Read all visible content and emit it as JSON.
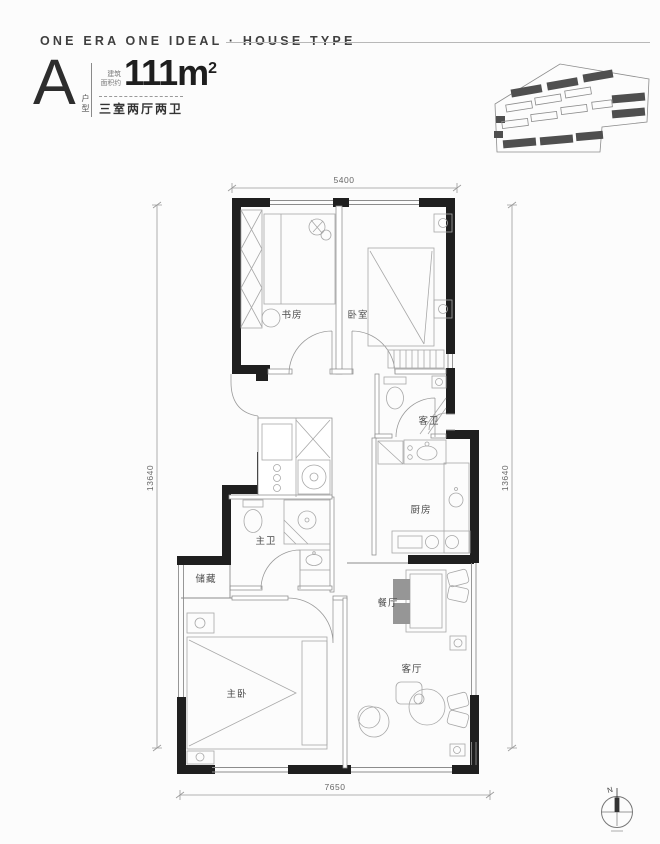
{
  "header": {
    "title": "ONE ERA ONE IDEAL · HOUSE TYPE"
  },
  "unit": {
    "letter": "A",
    "letter_caption": "户型",
    "area_label_line1": "建筑",
    "area_label_line2": "面积约",
    "area_value": "111m",
    "area_sup": "2",
    "layout_text": "三室两厅两卫"
  },
  "floorplan": {
    "dimensions": {
      "top": "5400",
      "left": "13640",
      "right": "13640",
      "bottom": "7650"
    },
    "rooms": [
      {
        "id": "study",
        "label": "书房"
      },
      {
        "id": "bedroom",
        "label": "卧室"
      },
      {
        "id": "guest-bath",
        "label": "客卫"
      },
      {
        "id": "kitchen",
        "label": "厨房"
      },
      {
        "id": "master-bath",
        "label": "主卫"
      },
      {
        "id": "storage",
        "label": "储藏"
      },
      {
        "id": "dining",
        "label": "餐厅"
      },
      {
        "id": "master-bedroom",
        "label": "主卧"
      },
      {
        "id": "living",
        "label": "客厅"
      }
    ],
    "compass": {
      "label": "N"
    }
  },
  "colors": {
    "wall": "#1f1f1f",
    "thin_line": "#8c8c8c",
    "furniture": "#a8a8a8",
    "text": "#3f3f3f"
  }
}
